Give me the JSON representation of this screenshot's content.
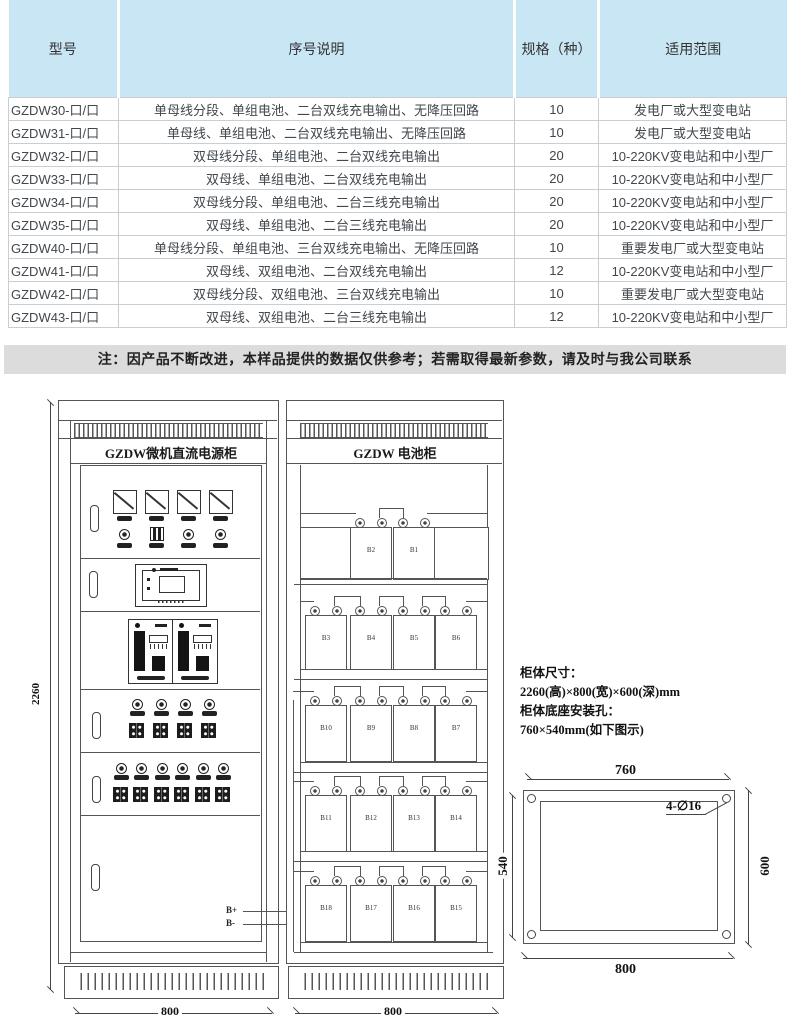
{
  "table": {
    "headers": [
      "型号",
      "序号说明",
      "规格（种）",
      "适用范围"
    ],
    "rows": [
      [
        "GZDW30-口/口",
        "单母线分段、单组电池、二台双线充电输出、无降压回路",
        "10",
        "发电厂或大型变电站"
      ],
      [
        "GZDW31-口/口",
        "单母线、单组电池、二台双线充电输出、无降压回路",
        "10",
        "发电厂或大型变电站"
      ],
      [
        "GZDW32-口/口",
        "双母线分段、单组电池、二台双线充电输出",
        "20",
        "10-220KV变电站和中小型厂"
      ],
      [
        "GZDW33-口/口",
        "双母线、单组电池、二台双线充电输出",
        "20",
        "10-220KV变电站和中小型厂"
      ],
      [
        "GZDW34-口/口",
        "双母线分段、单组电池、二台三线充电输出",
        "20",
        "10-220KV变电站和中小型厂"
      ],
      [
        "GZDW35-口/口",
        "双母线、单组电池、二台三线充电输出",
        "20",
        "10-220KV变电站和中小型厂"
      ],
      [
        "GZDW40-口/口",
        "单母线分段、单组电池、三台双线充电输出、无降压回路",
        "10",
        "重要发电厂或大型变电站"
      ],
      [
        "GZDW41-口/口",
        "双母线、双组电池、二台双线充电输出",
        "12",
        "10-220KV变电站和中小型厂"
      ],
      [
        "GZDW42-口/口",
        "双母线分段、双组电池、三台双线充电输出",
        "10",
        "重要发电厂或大型变电站"
      ],
      [
        "GZDW43-口/口",
        "双母线、双组电池、二台三线充电输出",
        "12",
        "10-220KV变电站和中小型厂"
      ]
    ]
  },
  "note": "注：因产品不断改进，本样品提供的数据仅供参考；若需取得最新参数，请及时与我公司联系",
  "power_cabinet": {
    "title": "GZDW微机直流电源柜",
    "width_dim": "800",
    "height_dim": "2260",
    "terminal_pos": "B+",
    "terminal_neg": "B-"
  },
  "battery_cabinet": {
    "title": "GZDW 电池柜",
    "width_dim": "800",
    "battery_rows": [
      [
        "B2",
        "B1"
      ],
      [
        "B3",
        "B4",
        "B5",
        "B6"
      ],
      [
        "B10",
        "B9",
        "B8",
        "B7"
      ],
      [
        "B11",
        "B12",
        "B13",
        "B14"
      ],
      [
        "B18",
        "B17",
        "B16",
        "B15"
      ]
    ]
  },
  "specs": {
    "line1": "柜体尺寸：",
    "line2": "2260(高)×800(宽)×600(深)mm",
    "line3": "柜体底座安装孔：",
    "line4": "760×540mm(如下图示)"
  },
  "mount": {
    "top_dim": "760",
    "bottom_dim": "800",
    "left_dim": "540",
    "right_dim": "600",
    "hole_label": "4-∅16"
  },
  "colors": {
    "table_header_bg": "#c9e6f5",
    "note_bg": "#dcdcdc",
    "line": "#555555"
  }
}
